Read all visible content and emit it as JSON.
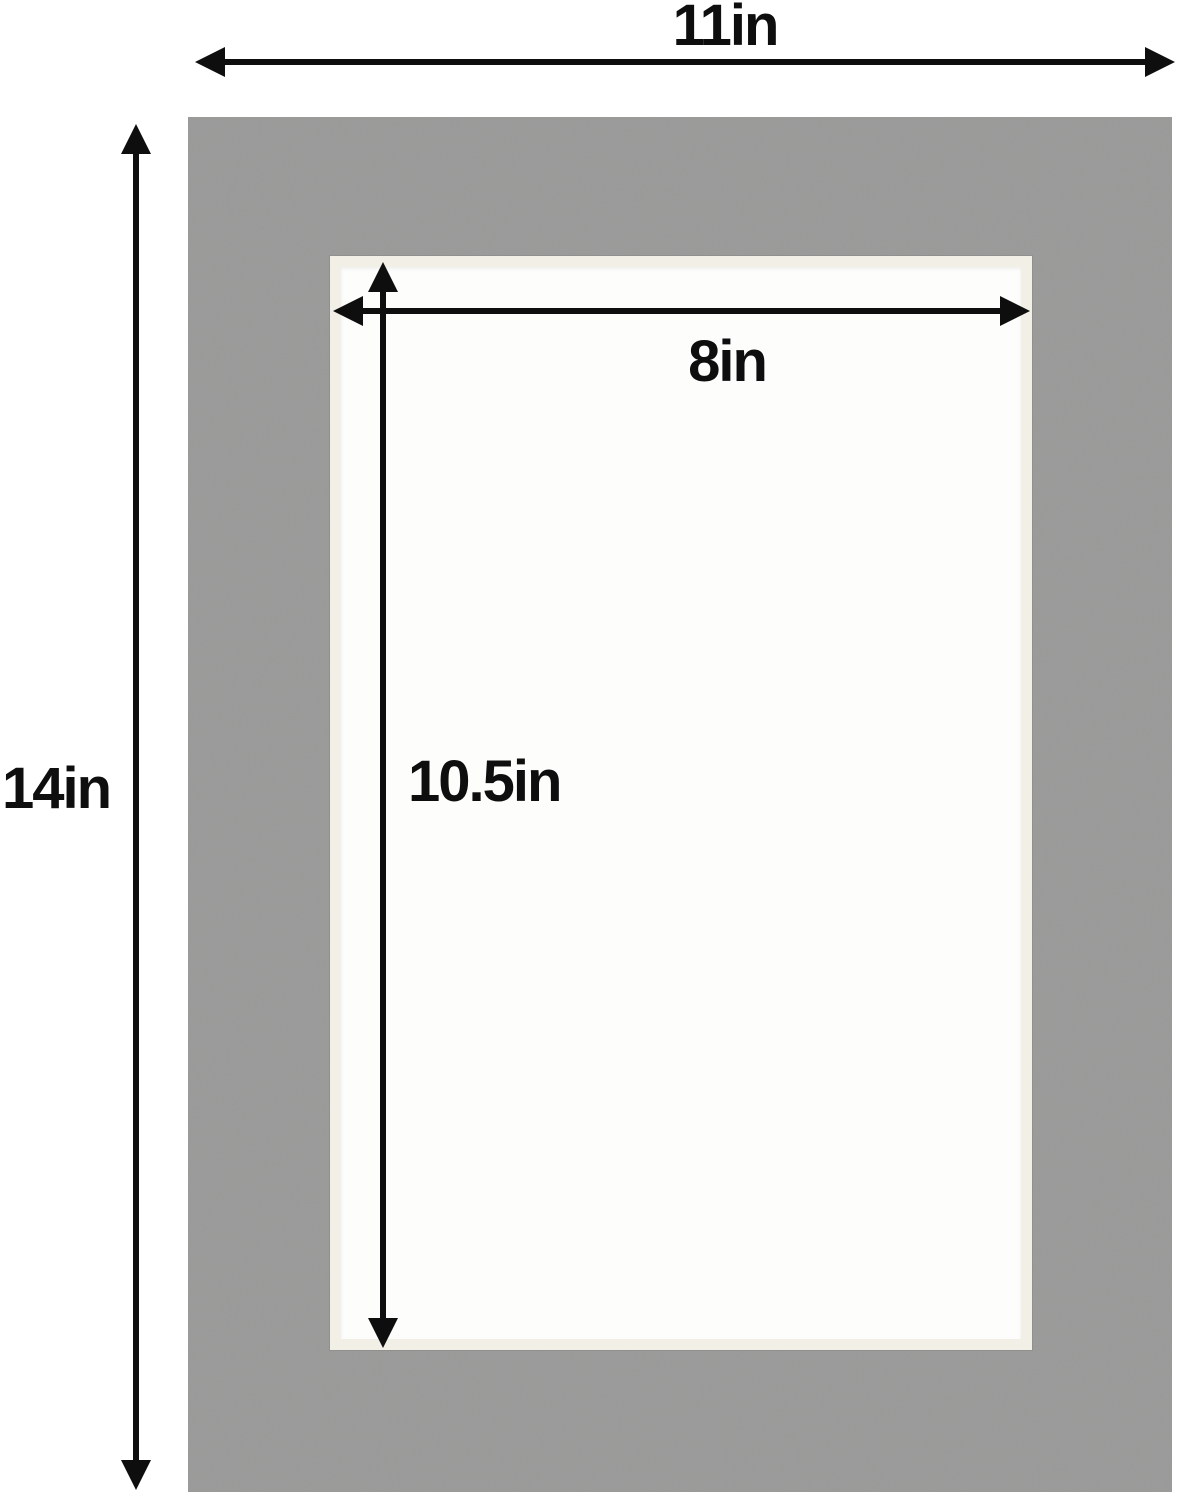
{
  "diagram": {
    "description": "Picture frame mat board with cut opening, annotated with dimensions",
    "labels": {
      "outer_width": "11in",
      "outer_height": "14in",
      "opening_width": "8in",
      "opening_height": "10.5in"
    }
  },
  "colors": {
    "bg": "#ffffff",
    "mat": "#9a9a99",
    "bevel": "#f1efe6",
    "opening": "#fdfdfc",
    "ink": "#0e0e0e"
  }
}
